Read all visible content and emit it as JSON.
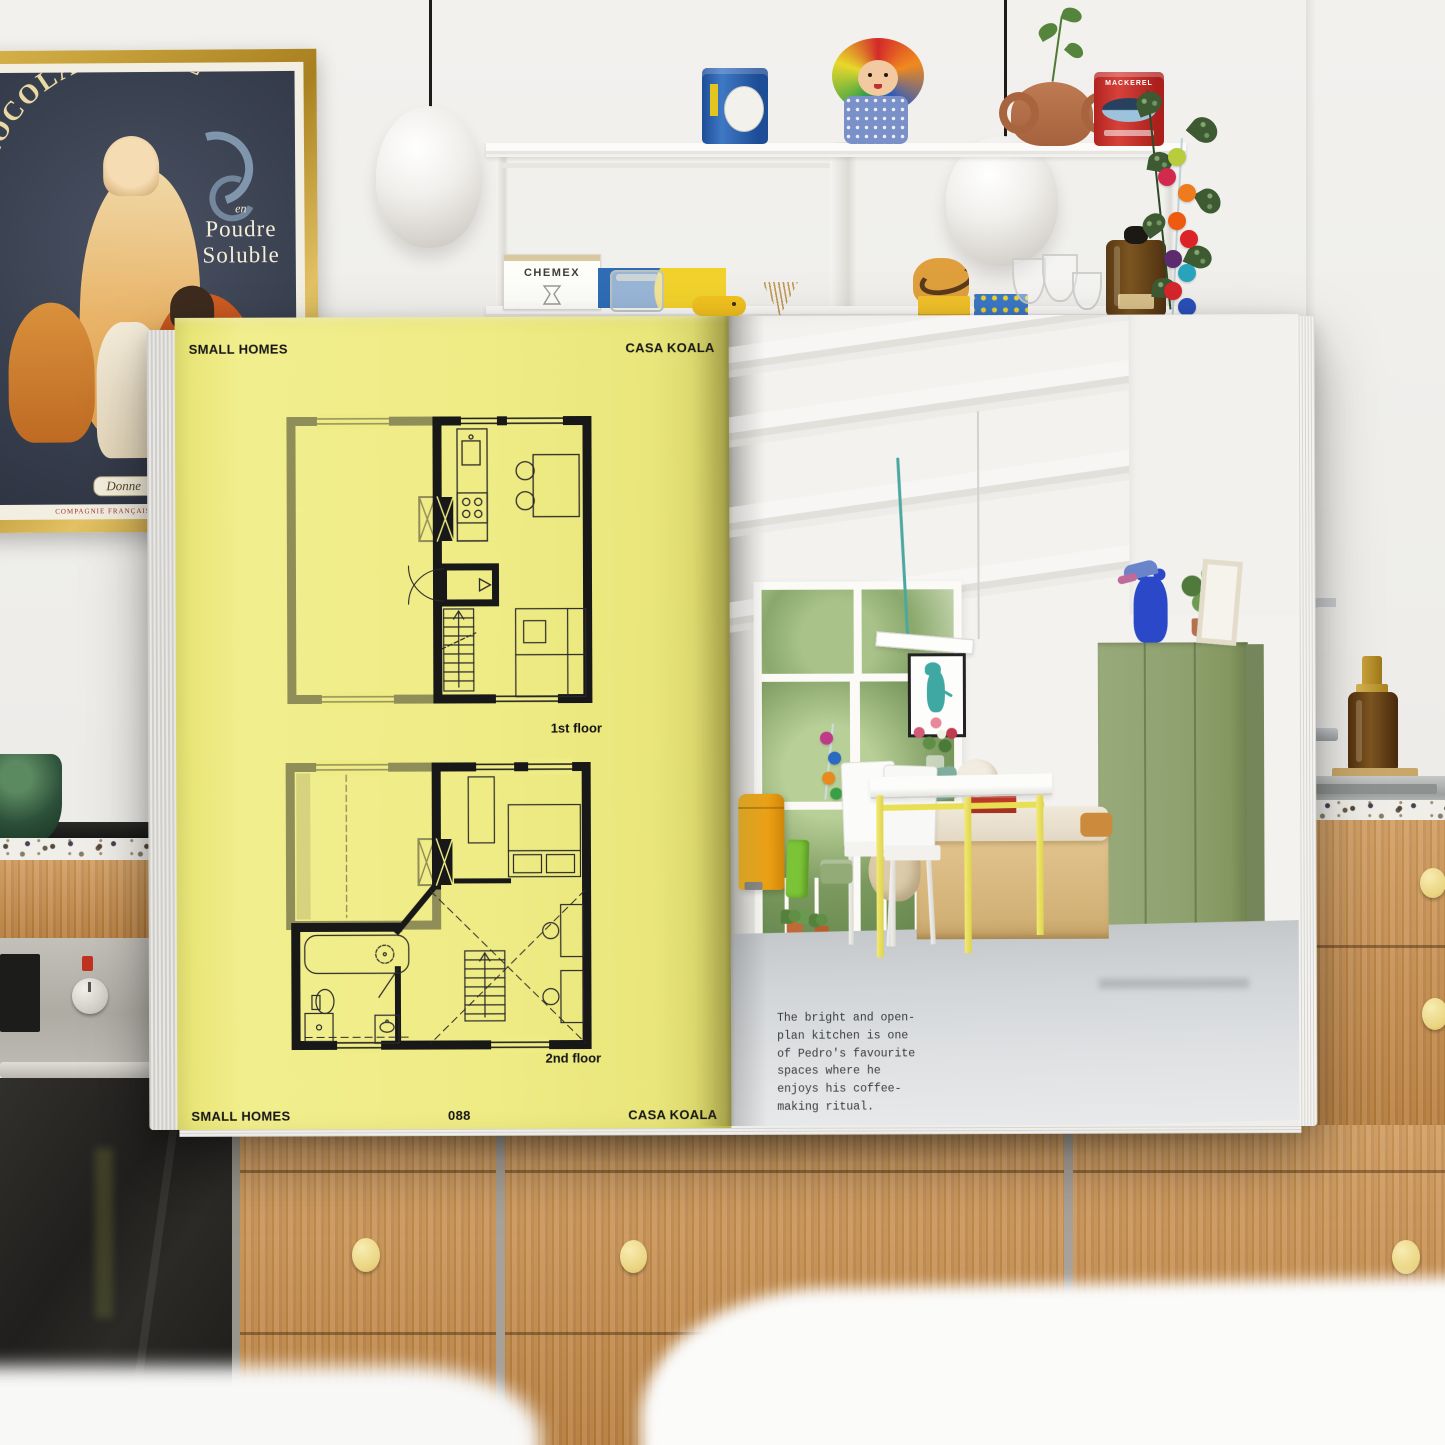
{
  "magazine": {
    "left_page": {
      "header_left": "SMALL HOMES",
      "header_right": "CASA KOALA",
      "plans": [
        {
          "label": "1st floor"
        },
        {
          "label": "2nd floor"
        }
      ],
      "footer_left": "SMALL HOMES",
      "page_number": "088",
      "footer_right": "CASA KOALA",
      "page_color": "#efec86"
    },
    "right_page": {
      "caption": "The bright and open-\nplan kitchen is one\nof Pedro's favourite\nspaces where he\nenjoys his coffee-\nmaking ritual."
    },
    "colors": {
      "table_yellow": "#ece45e",
      "cabinet_olive": "#8fa06f",
      "bin_orange": "#f0a81e",
      "floor_grey": "#ccd0d3"
    }
  },
  "background_scene": {
    "poster": {
      "title": "CHOCOLAT·IDÉAL",
      "subtitle_small": "en",
      "subtitle_line1": "Poudre",
      "subtitle_line2": "Soluble",
      "banner_text": "Donne",
      "bottom_text": "COMPAGNIE FRANÇAISE DES CHOCOLATS"
    },
    "chemex_box_label": "CHEMEX",
    "mackerel_tin_label": "MACKEREL"
  }
}
